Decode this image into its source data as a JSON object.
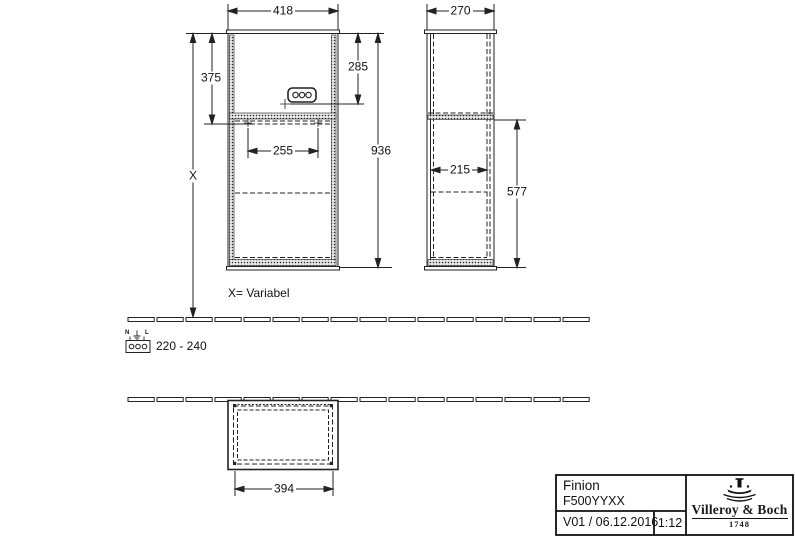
{
  "drawing": {
    "colors": {
      "line": "#222222",
      "background": "#ffffff"
    },
    "dims": {
      "front_width": "418",
      "front_upper_height": "375",
      "front_socket_height": "285",
      "front_inner_width": "255",
      "front_total_height": "936",
      "variable_height": "X",
      "variable_note": "X= Variabel",
      "side_depth": "270",
      "side_inner_depth": "215",
      "side_lower_height": "577",
      "plan_width": "394"
    },
    "electrical": {
      "voltage_range": "220 - 240",
      "neutral": "N",
      "live": "L"
    },
    "titleblock": {
      "product": "Finion",
      "article": "F500YYXX",
      "version": "V01 / 06.12.2016",
      "scale": "1:12",
      "brand": "Villeroy & Boch",
      "brand_year": "1748"
    }
  }
}
